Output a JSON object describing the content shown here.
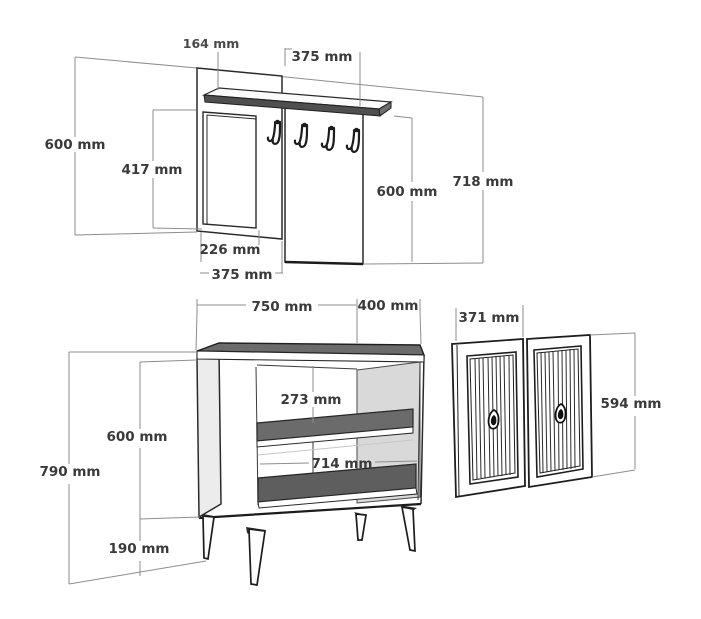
{
  "title": "Furniture dimension diagram",
  "unit": "mm",
  "colors": {
    "background": "#ffffff",
    "line": "#2a2a2a",
    "dimension_line": "#8d8d8d",
    "label_text": "#3a3a3a",
    "dark_panel_fill": "#6b6b6b",
    "shelf_front_fill": "#4f4f4f",
    "light_panel_fill": "#e6e6e6",
    "interior_wall_fill": "#d9d9d9"
  },
  "wall_unit": {
    "name": "wall-mounted coat rack with mirror and shelf",
    "hook_count": 4,
    "dims": {
      "shelf_depth": "164 mm",
      "hook_panel_width": "375 mm",
      "back_height": "600 mm",
      "mirror_height": "417 mm",
      "panel_height": "600 mm",
      "total_height": "718 mm",
      "mirror_width": "226 mm",
      "mirror_panel_width": "375 mm"
    }
  },
  "cabinet": {
    "name": "shoe cabinet carcass on legs",
    "leg_count": 4,
    "dims": {
      "width": "750 mm",
      "depth": "400 mm",
      "upper_opening_height": "273 mm",
      "inner_width": "714 mm",
      "body_height": "600 mm",
      "total_height": "790 mm",
      "leg_height": "190 mm"
    }
  },
  "doors": {
    "name": "slatted cabinet doors",
    "door_count": 2,
    "dims": {
      "door_width": "371 mm",
      "door_height": "594 mm"
    }
  }
}
